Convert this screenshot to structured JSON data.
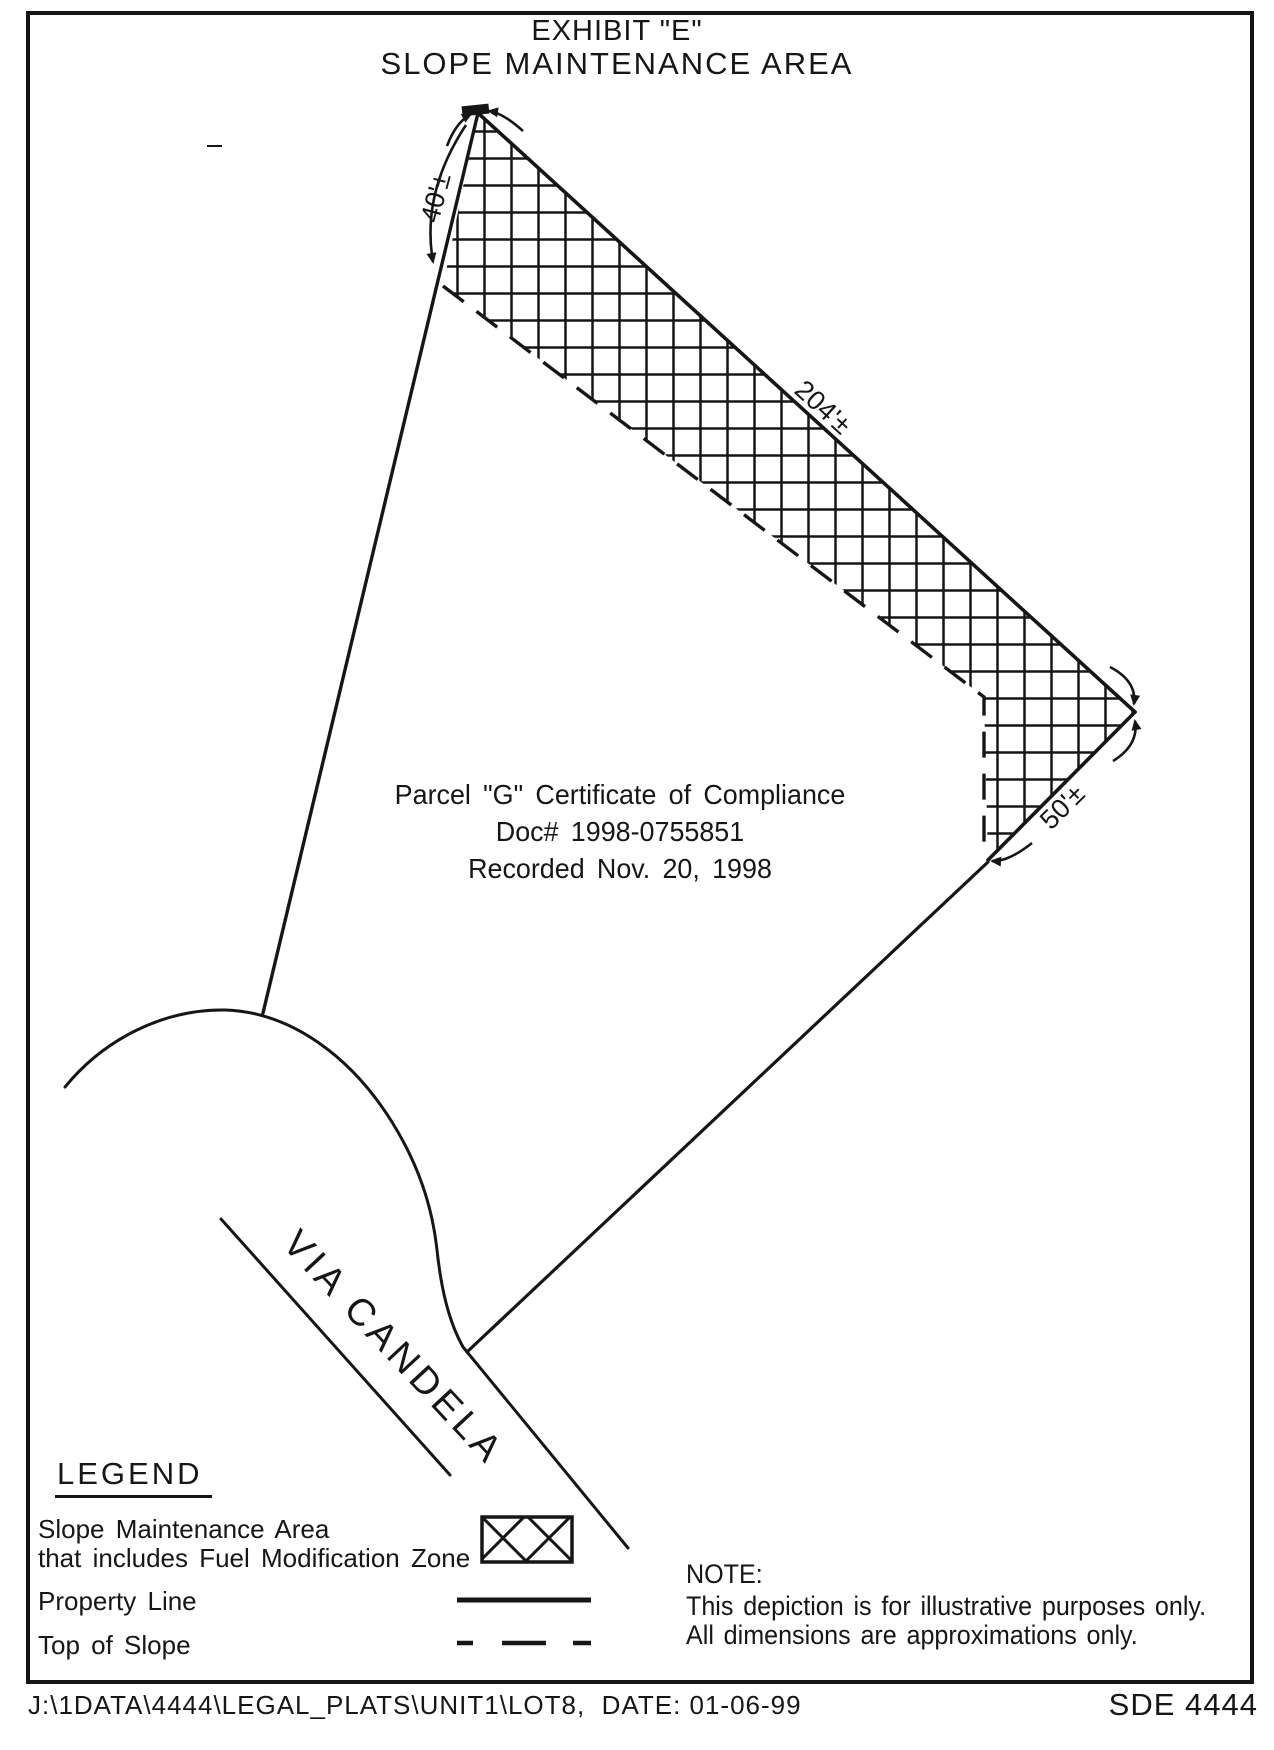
{
  "title": {
    "line1": "EXHIBIT \"E\"",
    "line2": "SLOPE MAINTENANCE AREA"
  },
  "parcel_note": {
    "line1": "Parcel \"G\" Certificate of Compliance",
    "line2": "Doc# 1998-0755851",
    "line3": "Recorded Nov. 20, 1998"
  },
  "dimensions": {
    "left_edge": "40'±",
    "long_edge": "204'±",
    "right_edge": "50'±"
  },
  "street": {
    "name": "VIA CANDELA"
  },
  "legend": {
    "heading": "LEGEND",
    "items": [
      {
        "label_line1": "Slope Maintenance Area",
        "label_line2": "that includes Fuel Modification Zone",
        "swatch": "crosshatch"
      },
      {
        "label_line1": "Property Line",
        "swatch": "solid-line"
      },
      {
        "label_line1": "Top of Slope",
        "swatch": "dashed-line"
      }
    ]
  },
  "note": {
    "heading": "NOTE:",
    "line1": "This depiction is for illustrative purposes only.",
    "line2": "All dimensions are approximations only."
  },
  "footer": {
    "file_path": "J:\\1DATA\\4444\\LEGAL_PLATS\\UNIT1\\LOT8,  DATE: 01-06-99",
    "sheet_id": "SDE 4444"
  },
  "colors": {
    "ink": "#161616",
    "paper": "#ffffff"
  }
}
